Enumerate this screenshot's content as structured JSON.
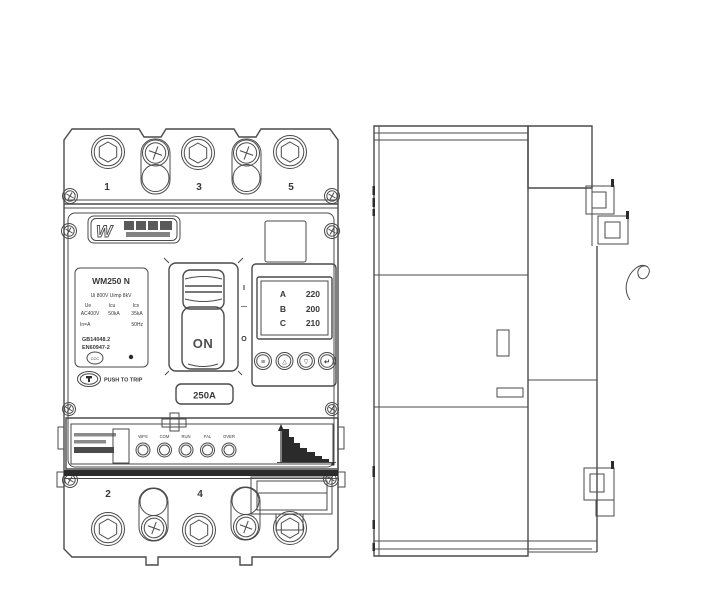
{
  "front_view": {
    "terminals_top": [
      "1",
      "3",
      "5"
    ],
    "terminals_bottom": [
      "2",
      "4"
    ],
    "brand": {
      "logo_mark": "W"
    },
    "nameplate": {
      "model": "WM250 N",
      "line1": "Ui 800V Uimp 8kV",
      "elec_headers": [
        "Ue",
        "Icu",
        "Ics"
      ],
      "elec_values": [
        "AC400V",
        "50kA",
        "35kA"
      ],
      "line4_left": "In=A",
      "line4_right": "50Hz",
      "std1": "GB14048.2",
      "std2": "EN60947-2",
      "cert_mark": "CCC"
    },
    "push_to_trip": "PUSH TO TRIP",
    "handle": {
      "label": "ON",
      "marks": [
        "I",
        "—",
        "O"
      ]
    },
    "rating": "250A",
    "display": {
      "rows": [
        {
          "phase": "A",
          "value": "220"
        },
        {
          "phase": "B",
          "value": "200"
        },
        {
          "phase": "C",
          "value": "210"
        }
      ],
      "buttons": [
        {
          "name": "menu",
          "glyph": "≡"
        },
        {
          "name": "up",
          "glyph": "△"
        },
        {
          "name": "down",
          "glyph": "▽"
        },
        {
          "name": "enter",
          "glyph": "↵"
        }
      ]
    },
    "leds": [
      "WPS",
      "COM",
      "RUN",
      "FAL",
      "OVER"
    ]
  },
  "colors": {
    "line": "#4a4a4a",
    "dark": "#2b2b2b",
    "background": "#ffffff"
  }
}
